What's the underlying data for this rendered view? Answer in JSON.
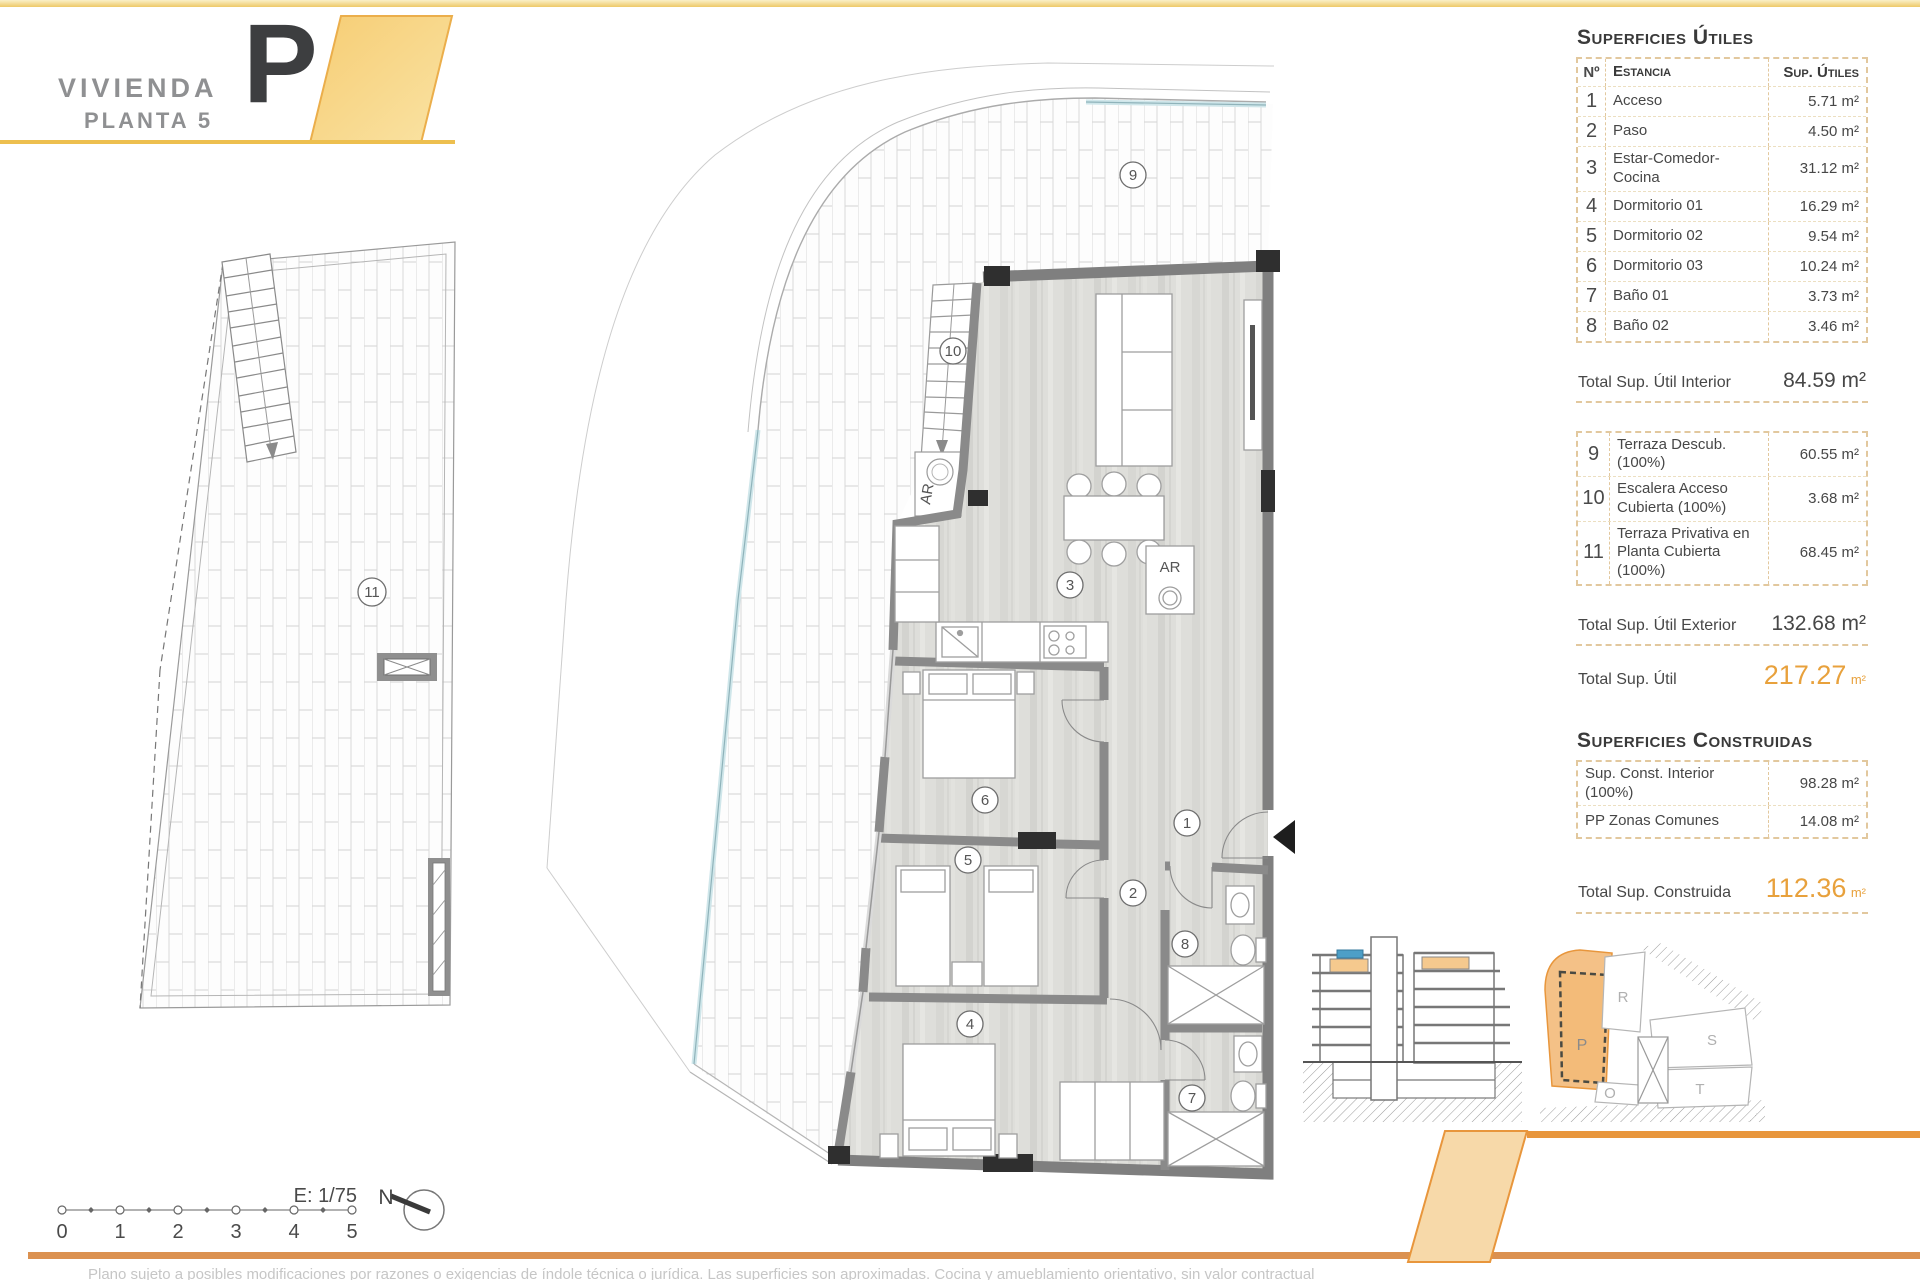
{
  "header": {
    "title": "VIVIENDA",
    "subtitle": "PLANTA 5",
    "unit_letter": "P"
  },
  "tables": {
    "useful": {
      "title": "Superficies Útiles",
      "columns": {
        "num": "Nº",
        "name": "Estancia",
        "area": "Sup. Útiles"
      },
      "rows": [
        {
          "num": "1",
          "name": "Acceso",
          "area": "5.71 m²"
        },
        {
          "num": "2",
          "name": "Paso",
          "area": "4.50 m²"
        },
        {
          "num": "3",
          "name": "Estar-Comedor-Cocina",
          "area": "31.12 m²"
        },
        {
          "num": "4",
          "name": "Dormitorio 01",
          "area": "16.29 m²"
        },
        {
          "num": "5",
          "name": "Dormitorio 02",
          "area": "9.54 m²"
        },
        {
          "num": "6",
          "name": "Dormitorio 03",
          "area": "10.24 m²"
        },
        {
          "num": "7",
          "name": "Baño 01",
          "area": "3.73 m²"
        },
        {
          "num": "8",
          "name": "Baño 02",
          "area": "3.46 m²"
        }
      ],
      "total_interior": {
        "label": "Total Sup. Útil Interior",
        "value": "84.59 m²"
      },
      "exterior_rows": [
        {
          "num": "9",
          "name": "Terraza Descub.(100%)",
          "area": "60.55 m²"
        },
        {
          "num": "10",
          "name": "Escalera Acceso Cubierta (100%)",
          "area": "3.68 m²"
        },
        {
          "num": "11",
          "name": "Terraza Privativa en Planta Cubierta (100%)",
          "area": "68.45 m²"
        }
      ],
      "total_exterior": {
        "label": "Total Sup. Útil Exterior",
        "value": "132.68 m²"
      },
      "total": {
        "label": "Total Sup. Útil",
        "value": "217.27",
        "unit": "m²"
      }
    },
    "built": {
      "title": "Superficies Construidas",
      "rows": [
        {
          "name": "Sup. Const. Interior (100%)",
          "area": "98.28 m²"
        },
        {
          "name": "PP Zonas Comunes",
          "area": "14.08 m²"
        }
      ],
      "total": {
        "label": "Total Sup. Construida",
        "value": "112.36",
        "unit": "m²"
      }
    }
  },
  "plan": {
    "labels": {
      "r1": "1",
      "r2": "2",
      "r3": "3",
      "r4": "4",
      "r5": "5",
      "r6": "6",
      "r7": "7",
      "r8": "8",
      "r9": "9",
      "r10": "10",
      "r11": "11"
    },
    "ar": "AR"
  },
  "scalebar": {
    "label": "E: 1/75",
    "ticks": [
      "0",
      "1",
      "2",
      "3",
      "4",
      "5"
    ],
    "north": "N"
  },
  "site": {
    "p": "P",
    "r": "R",
    "s": "S",
    "o": "O",
    "t": "T"
  },
  "footer": {
    "disclaimer": "Plano sujeto a posibles modificaciones por razones o exigencias de índole técnica o jurídica. Las superficies son aproximadas. Cocina y amueblamiento orientativo, sin valor contractual"
  },
  "colors": {
    "accent": "#e8a13c",
    "bar_orange": "#db9150",
    "band_yellow": "#f3d788",
    "highlight_fill": "#f5c98e",
    "glass_blue": "#9fc6cf",
    "wall_gray": "#7f7f7f"
  }
}
